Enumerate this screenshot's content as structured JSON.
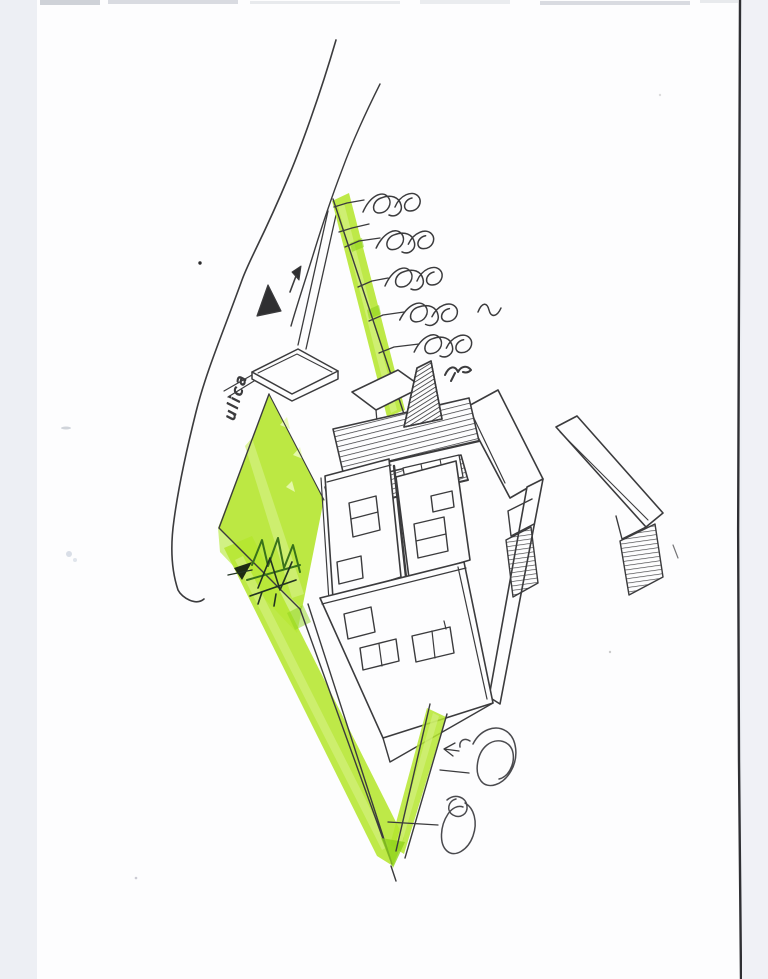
{
  "scene": {
    "kind": "hand-drawn axonometric architectural concept sketch, pen on scanned white paper with green highlighter",
    "street_label": "ulica"
  },
  "labels": {
    "street": "ulica"
  },
  "colors": {
    "scan_margin": "#edeff4",
    "paper": "#fdfdfe",
    "scan_edge_dark": "#2f2f33",
    "ink": "#3b3b3d",
    "highlighter_green": "#b5e62f",
    "highlighter_light": "#d3f07d",
    "highlighter_dark": "#90d31c",
    "foliage_dark_green": "#38721a"
  },
  "elements": [
    {
      "name": "street-curves",
      "kind": "long sweeping pen lines (road edge)"
    },
    {
      "name": "street-label",
      "text": "ulica",
      "rotation_deg": -74
    },
    {
      "name": "north-arrow",
      "kind": "filled pen triangle with small arrow"
    },
    {
      "name": "garage-outline",
      "kind": "small axonometric rectangle by street"
    },
    {
      "name": "entry-path",
      "kind": "green highlighter band with tick marks"
    },
    {
      "name": "path-trees",
      "kind": "spiral pen scribbles",
      "count": 5
    },
    {
      "name": "bird-mark",
      "kind": "small m-shaped pen squiggle"
    },
    {
      "name": "garden",
      "kind": "green highlighter diamond with dark plant scribble"
    },
    {
      "name": "house",
      "kind": "axonometric pen volumes with hatched pergola roofs and windows"
    },
    {
      "name": "boundary-path",
      "kind": "green highlighter V converging at plot tip"
    },
    {
      "name": "shrub-scribbles",
      "kind": "looping pen circles",
      "count": 2
    }
  ]
}
